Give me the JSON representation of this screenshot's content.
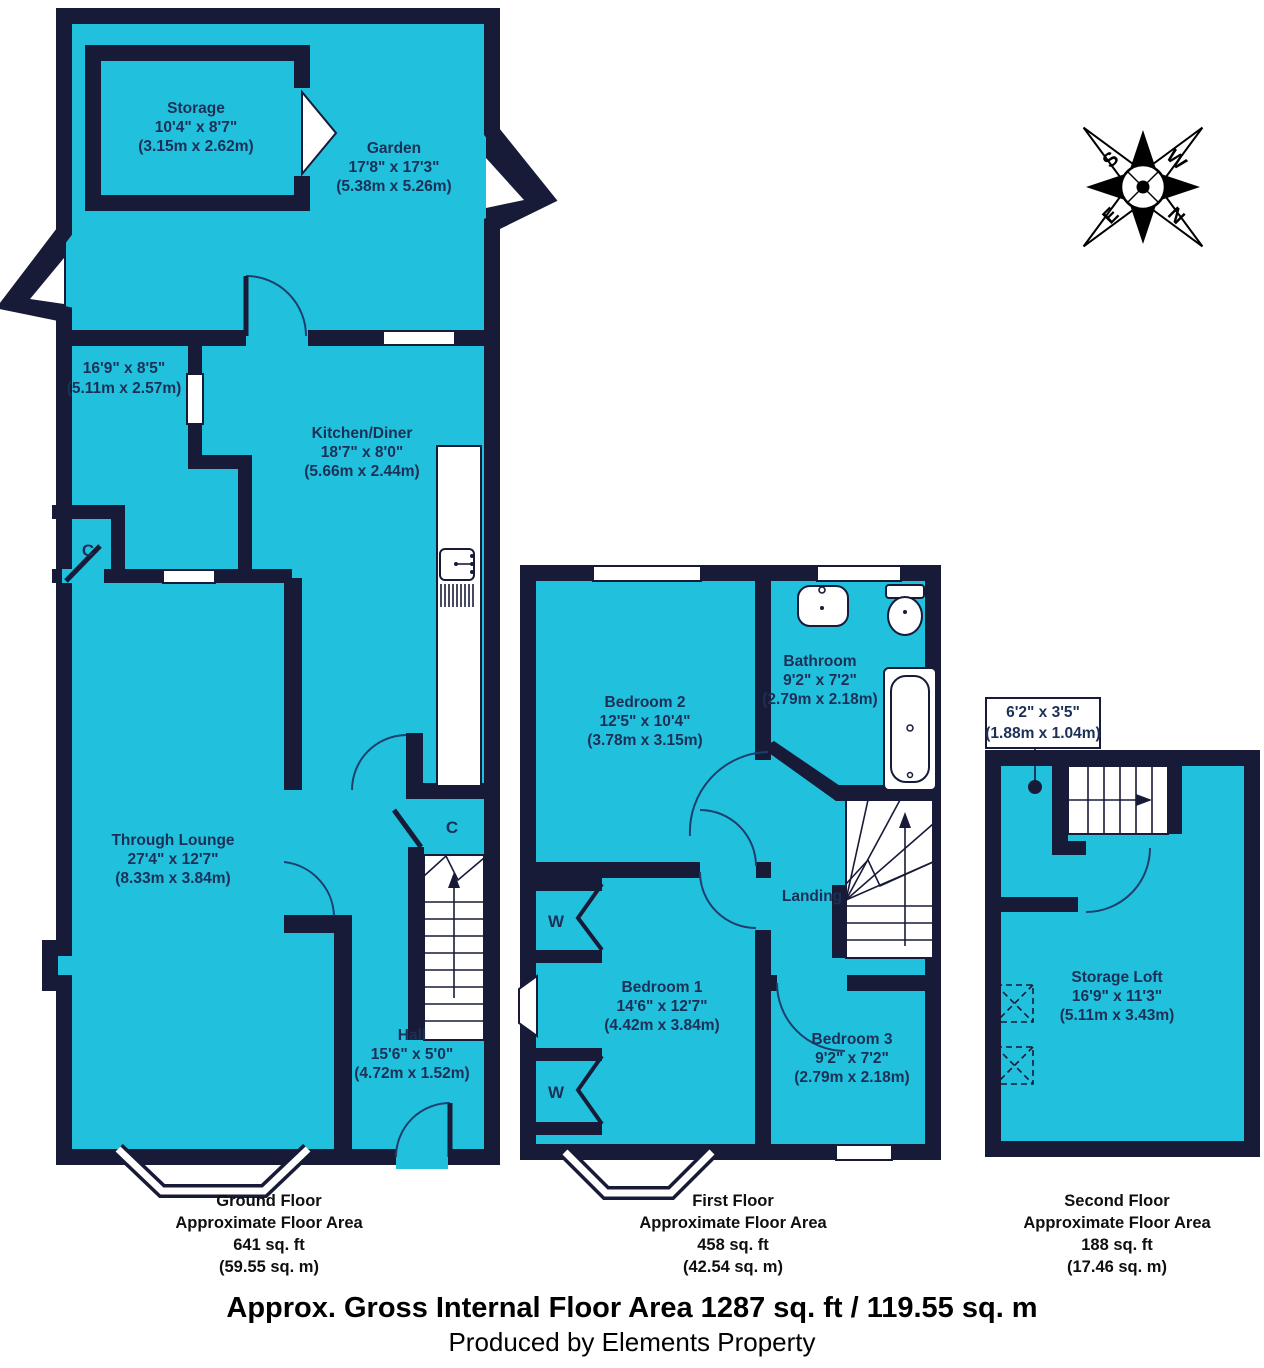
{
  "colors": {
    "room_fill": "#21c1dd",
    "wall": "#171b38",
    "room_text": "#1c3057",
    "caption_text": "#0f0f0f",
    "background": "#ffffff"
  },
  "compass": {
    "n": "N",
    "s": "S",
    "e": "E",
    "w": "W"
  },
  "ground": {
    "storage": {
      "name": "Storage",
      "imp": "10'4\" x 8'7\"",
      "met": "(3.15m x 2.62m)"
    },
    "garden": {
      "name": "Garden",
      "imp": "17'8\" x 17'3\"",
      "met": "(5.38m x 5.26m)"
    },
    "reception": {
      "imp": "16'9\" x 8'5\"",
      "met": "(5.11m x 2.57m)"
    },
    "kitchen": {
      "name": "Kitchen/Diner",
      "imp": "18'7\" x 8'0\"",
      "met": "(5.66m x 2.44m)"
    },
    "lounge": {
      "name": "Through Lounge",
      "imp": "27'4\" x 12'7\"",
      "met": "(8.33m x 3.84m)"
    },
    "hall": {
      "name": "Hall",
      "imp": "15'6\" x 5'0\"",
      "met": "(4.72m x 1.52m)"
    },
    "closet1": "C",
    "closet2": "C",
    "caption": {
      "l1": "Ground Floor",
      "l2": "Approximate Floor Area",
      "l3": "641 sq. ft",
      "l4": "(59.55 sq. m)"
    }
  },
  "first": {
    "bedroom2": {
      "name": "Bedroom 2",
      "imp": "12'5\" x 10'4\"",
      "met": "(3.78m x 3.15m)"
    },
    "bathroom": {
      "name": "Bathroom",
      "imp": "9'2\" x 7'2\"",
      "met": "(2.79m x 2.18m)"
    },
    "landing": {
      "name": "Landing"
    },
    "bedroom1": {
      "name": "Bedroom 1",
      "imp": "14'6\" x 12'7\"",
      "met": "(4.42m x 3.84m)"
    },
    "bedroom3": {
      "name": "Bedroom 3",
      "imp": "9'2\" x 7'2\"",
      "met": "(2.79m x 2.18m)"
    },
    "wardrobe1": "W",
    "wardrobe2": "W",
    "caption": {
      "l1": "First Floor",
      "l2": "Approximate Floor Area",
      "l3": "458 sq. ft",
      "l4": "(42.54 sq. m)"
    }
  },
  "second": {
    "callout": {
      "imp": "6'2\" x 3'5\"",
      "met": "(1.88m x 1.04m)"
    },
    "loft": {
      "name": "Storage Loft",
      "imp": "16'9\" x 11'3\"",
      "met": "(5.11m x 3.43m)"
    },
    "caption": {
      "l1": "Second Floor",
      "l2": "Approximate Floor Area",
      "l3": "188 sq. ft",
      "l4": "(17.46 sq. m)"
    }
  },
  "footer": {
    "line1": "Approx. Gross Internal Floor Area 1287 sq. ft / 119.55 sq. m",
    "line2": "Produced by Elements Property"
  }
}
